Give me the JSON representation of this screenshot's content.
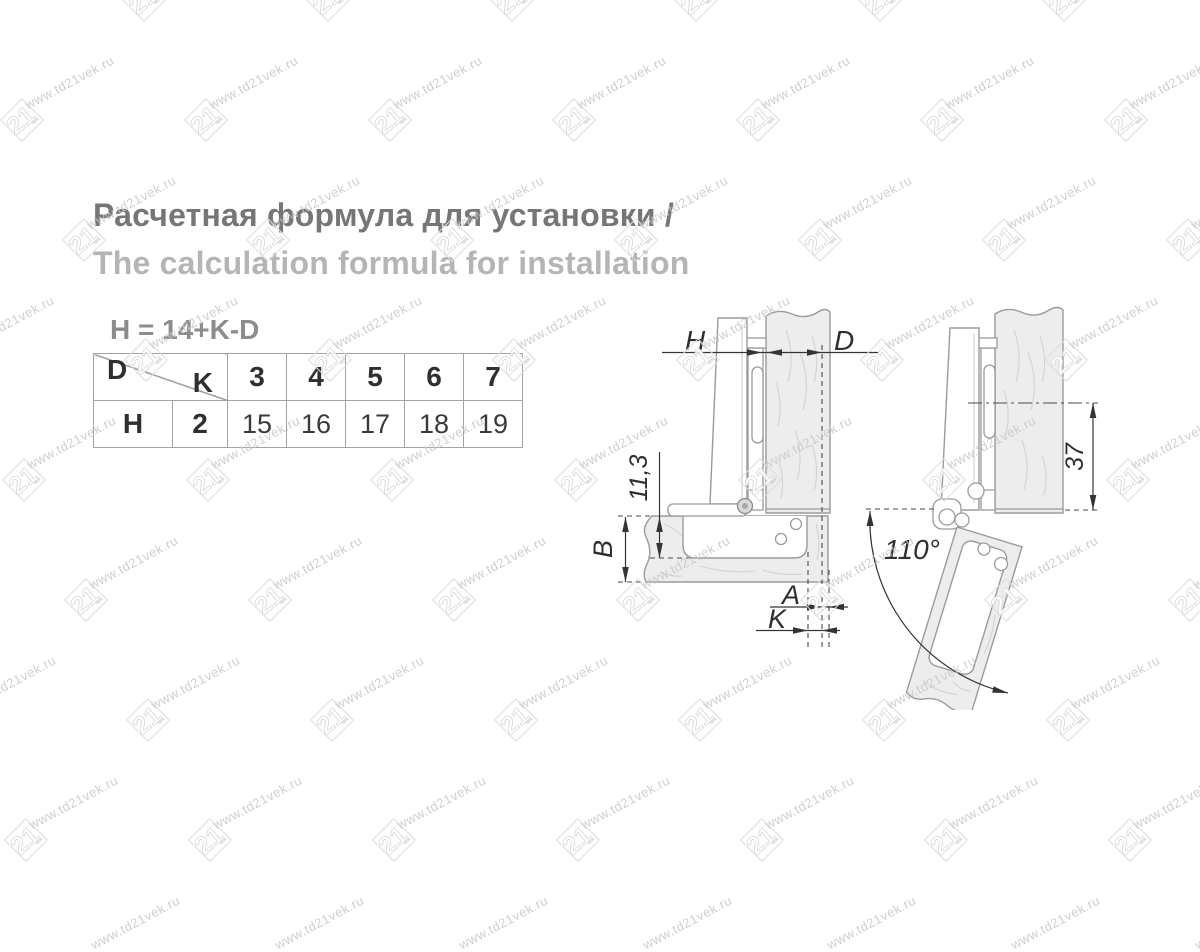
{
  "watermark": {
    "text": "www.td21vek.ru",
    "logo": "21",
    "logo_sub": "век"
  },
  "heading": {
    "title_ru": "Расчетная формула для установки /",
    "title_en": "The calculation formula for installation"
  },
  "formula": "H = 14+K-D",
  "table": {
    "corner_top": "D",
    "corner_bottom": "K",
    "header_values": [
      "3",
      "4",
      "5",
      "6",
      "7"
    ],
    "row_label": "H",
    "k_value": "2",
    "row_values": [
      "15",
      "16",
      "17",
      "18",
      "19"
    ]
  },
  "diagram": {
    "labels": {
      "h": "H",
      "d": "D",
      "cup_depth": "11,3",
      "b": "B",
      "a": "A",
      "k": "K",
      "offset": "37",
      "angle": "110°"
    }
  },
  "colors": {
    "title": "#767676",
    "subtitle": "#b5b5b5",
    "formula": "#8c8c8c",
    "outline": "#9b9b9b",
    "dimension": "#343434",
    "wood_fill": "#ededed",
    "watermark": "#c7c7c7"
  }
}
